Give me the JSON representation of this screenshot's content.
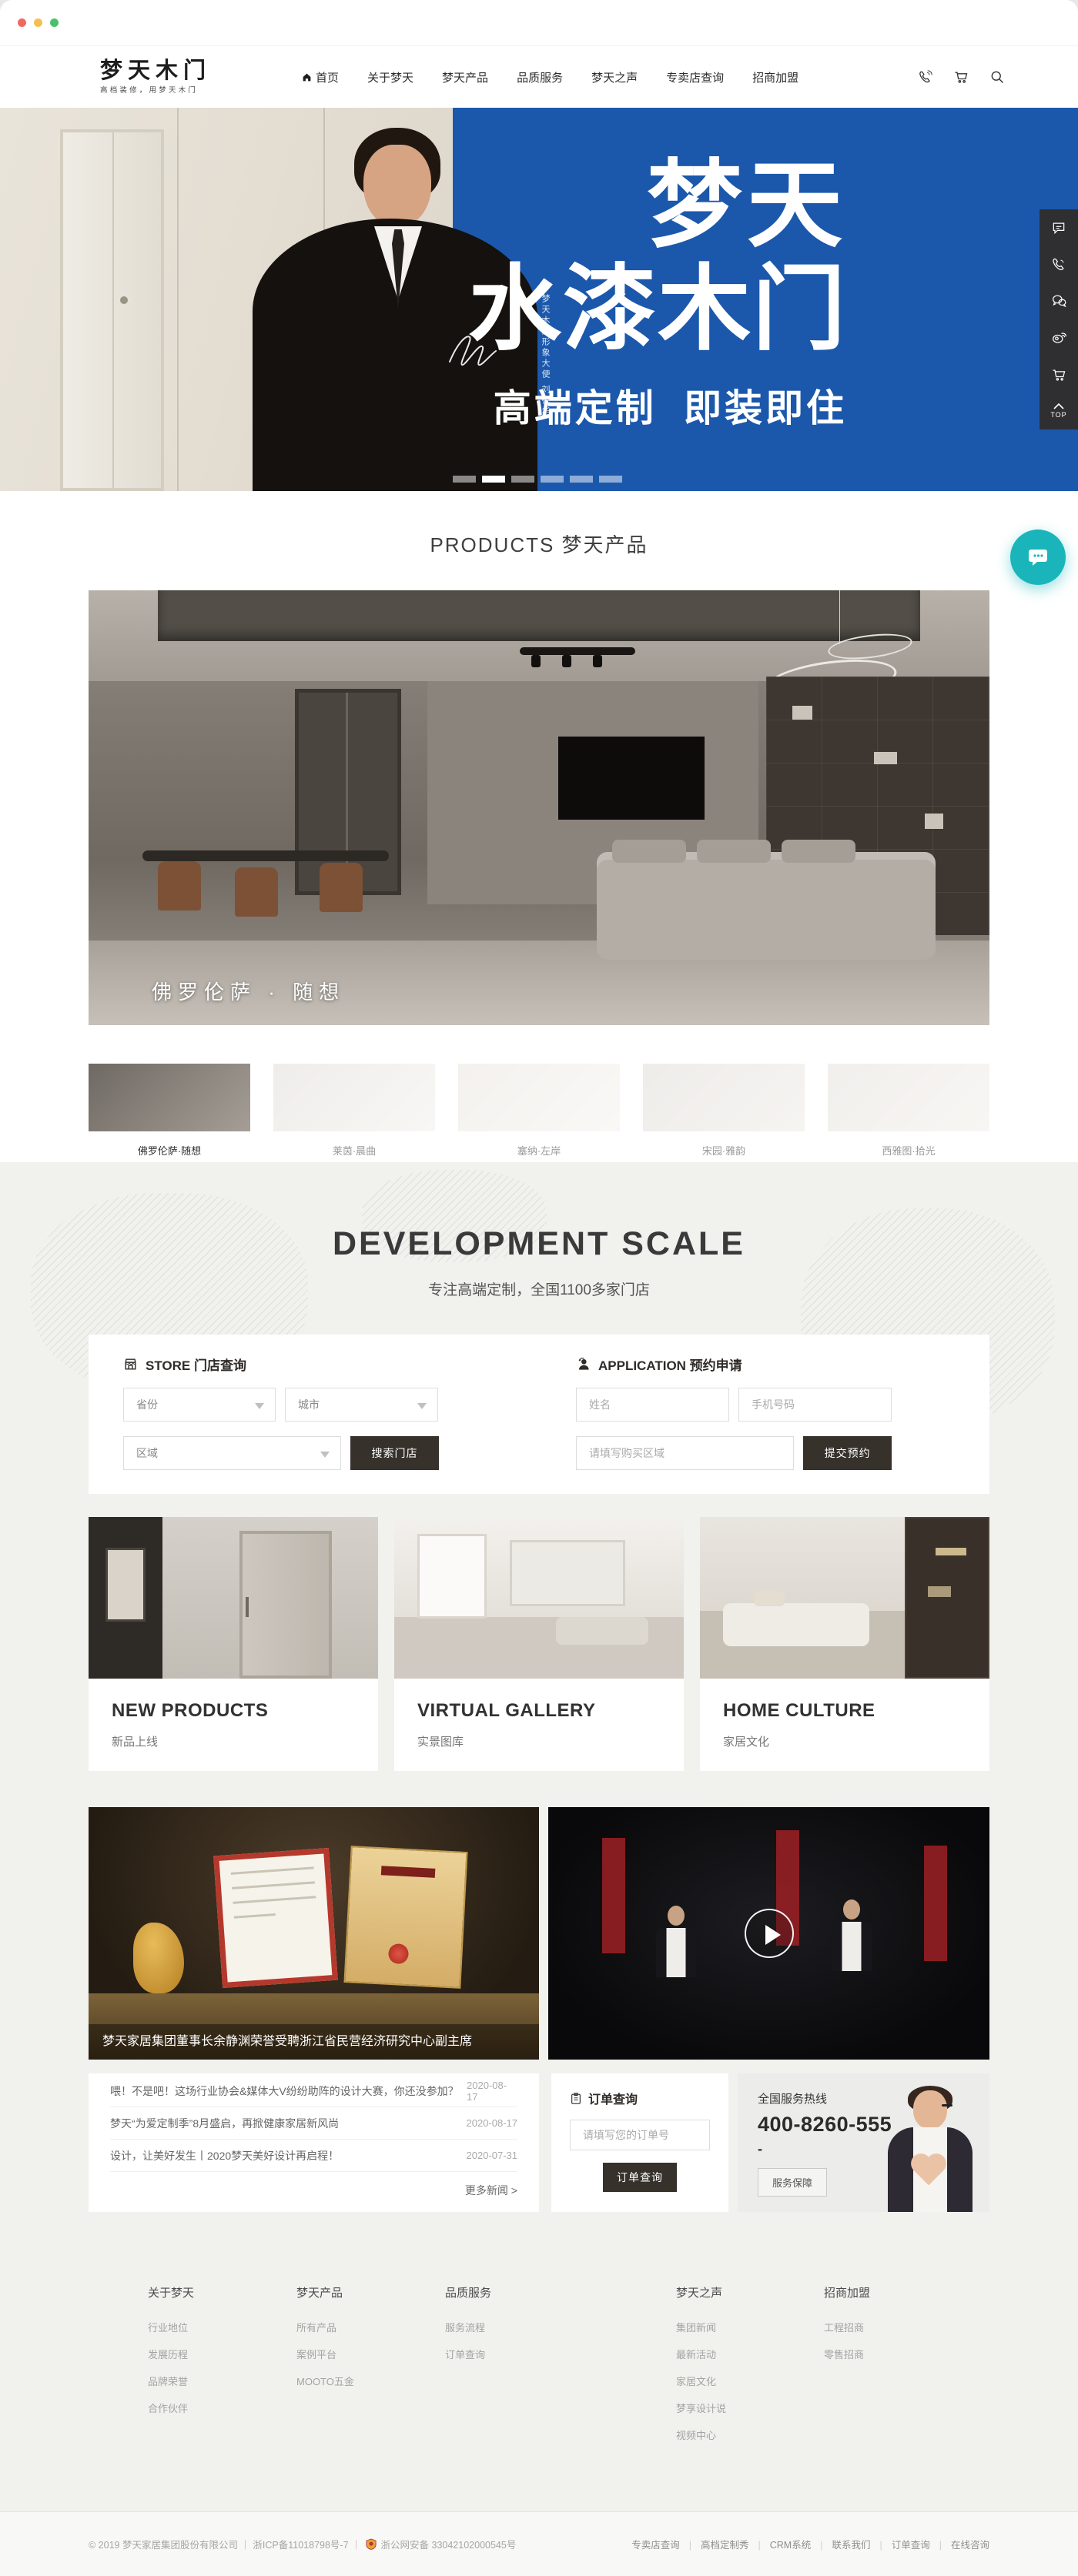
{
  "window": {
    "traffic_lights": [
      "#ee6a5f",
      "#f5bf4f",
      "#46c26a"
    ]
  },
  "header": {
    "logo_title": "梦天木门",
    "logo_tagline": "高档装修，用梦天木门",
    "nav": [
      {
        "label": "首页"
      },
      {
        "label": "关于梦天"
      },
      {
        "label": "梦天产品"
      },
      {
        "label": "品质服务"
      },
      {
        "label": "梦天之声"
      },
      {
        "label": "专卖店查询"
      },
      {
        "label": "招商加盟"
      }
    ]
  },
  "hero": {
    "title_line1": "梦天",
    "title_line2": "水漆木门",
    "subtitle": "高端定制  即装即住",
    "ambassador_note": "梦天木门形象大使 刘德华",
    "slide_count": 6,
    "active_slide": 2,
    "accent_blue": "#1b58ac"
  },
  "side_toolbar": {
    "top_label": "TOP"
  },
  "floating_chat_color": "#19b5ba",
  "products": {
    "section_title": "PRODUCTS 梦天产品",
    "featured_caption": "佛罗伦萨 · 随想",
    "thumbnails": [
      {
        "label": "佛罗伦萨·随想"
      },
      {
        "label": "莱茵·晨曲"
      },
      {
        "label": "塞纳·左岸"
      },
      {
        "label": "宋园·雅韵"
      },
      {
        "label": "西雅图·拾光"
      }
    ]
  },
  "development": {
    "title": "DEVELOPMENT SCALE",
    "subtitle": "专注高端定制，全国1100多家门店",
    "store_form": {
      "title": "STORE 门店查询",
      "province_placeholder": "省份",
      "city_placeholder": "城市",
      "district_placeholder": "区域",
      "search_button": "搜索门店"
    },
    "application_form": {
      "title": "APPLICATION 预约申请",
      "name_placeholder": "姓名",
      "phone_placeholder": "手机号码",
      "area_placeholder": "请填写购买区域",
      "submit_button": "提交预约"
    }
  },
  "feature_cards": [
    {
      "title": "NEW PRODUCTS",
      "subtitle": "新品上线"
    },
    {
      "title": "VIRTUAL GALLERY",
      "subtitle": "实景图库"
    },
    {
      "title": "HOME CULTURE",
      "subtitle": "家居文化"
    }
  ],
  "news": {
    "featured_caption": "梦天家居集团董事长余静渊荣誉受聘浙江省民营经济研究中心副主席",
    "items": [
      {
        "title": "喂！不是吧！这场行业协会&媒体大V纷纷助阵的设计大赛，你还没参加？",
        "date": "2020-08-17"
      },
      {
        "title": "梦天“为爱定制季”8月盛启，再掀健康家居新风尚",
        "date": "2020-08-17"
      },
      {
        "title": "设计，让美好发生丨2020梦天美好设计再启程！",
        "date": "2020-07-31"
      }
    ],
    "more_label": "更多新闻 >"
  },
  "order_query": {
    "title": "订单查询",
    "input_placeholder": "请填写您的订单号",
    "button": "订单查询"
  },
  "hotline": {
    "label": "全国服务热线",
    "number": "400-8260-555",
    "dash": "-",
    "service_button": "服务保障"
  },
  "footer": {
    "columns": [
      {
        "title": "关于梦天",
        "links": [
          "行业地位",
          "发展历程",
          "品牌荣誉",
          "合作伙伴"
        ]
      },
      {
        "title": "梦天产品",
        "links": [
          "所有产品",
          "案例平台",
          "MOOTO五金"
        ]
      },
      {
        "title": "品质服务",
        "links": [
          "服务流程",
          "订单查询"
        ]
      },
      {
        "title": "梦天之声",
        "links": [
          "集团新闻",
          "最新活动",
          "家居文化",
          "梦享设计说",
          "视频中心"
        ]
      },
      {
        "title": "招商加盟",
        "links": [
          "工程招商",
          "零售招商"
        ]
      }
    ],
    "copyright": "© 2019 梦天家居集团股份有限公司 ｜ 浙ICP备11018798号-7 ｜",
    "police_record": "浙公网安备 33042102000545号",
    "bottom_links": [
      "专卖店查询",
      "高档定制秀",
      "CRM系统",
      "联系我们",
      "订单查询",
      "在线咨询"
    ]
  }
}
